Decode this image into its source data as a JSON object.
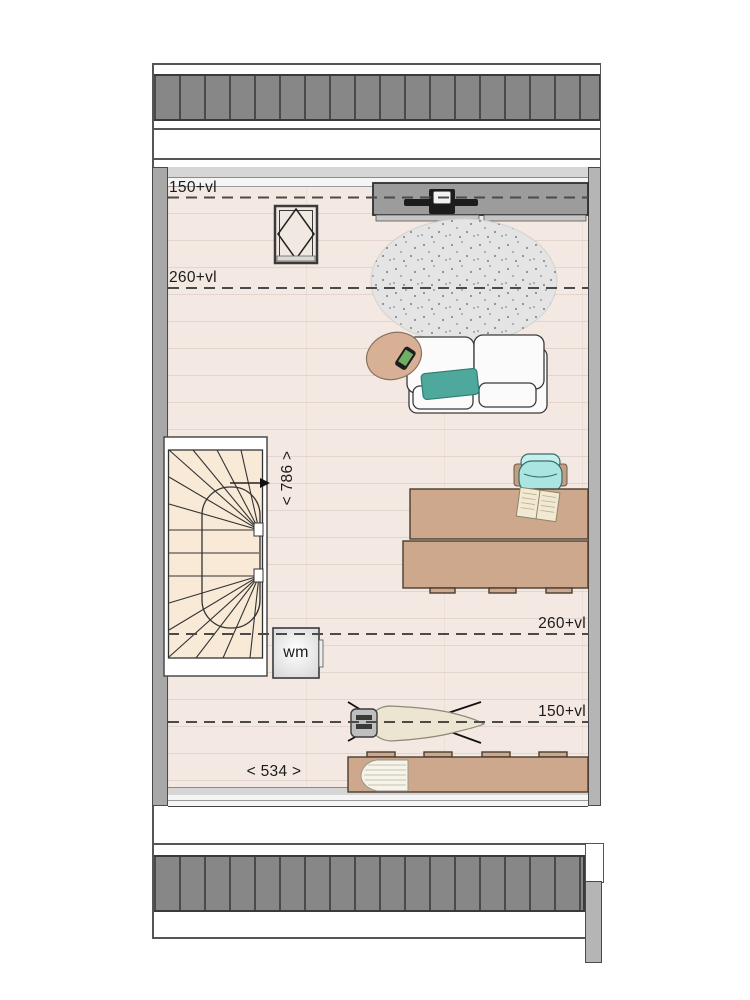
{
  "plan": {
    "title": "attic floor plan",
    "annotations": {
      "height_line_150_top": "150+vl",
      "height_line_260_top": "260+vl",
      "height_line_260_bottom": "260+vl",
      "height_line_150_bottom": "150+vl",
      "stair_depth_dimension": "< 786 >",
      "room_width_dimension": "< 534 >"
    },
    "appliances": {
      "washing_machine_label": "wm"
    },
    "icons": [
      "tv-icon",
      "roof-window-icon",
      "phone-icon",
      "open-book-icon",
      "iron-icon",
      "magazine-icon",
      "walking-line-arrow-icon"
    ],
    "colors": {
      "floor": "#f4e9e2",
      "stairs": "#f8ead7",
      "wall": "#a8a8a8",
      "roof_hatch": "#878787",
      "wood_furniture": "#cda88d",
      "wardrobe": "#9c9c9c",
      "rug": "#e4e4e4",
      "pillow": "#4ea89b",
      "chair": "#abe7e3",
      "table": "#d8b096"
    }
  }
}
